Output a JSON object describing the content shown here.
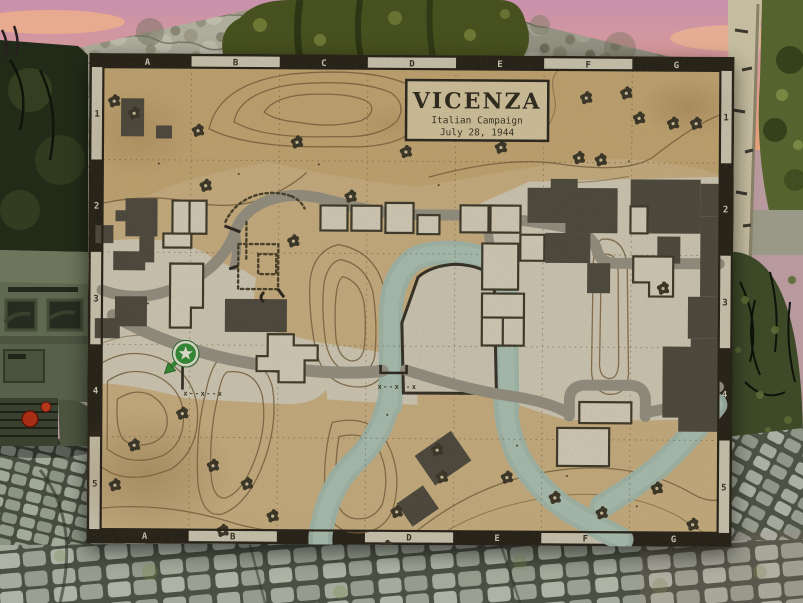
{
  "scene": {
    "colors": {
      "sky_pink": "#cf93ae",
      "sky_orange": "#e8a178",
      "tree_foliage": "#47501f",
      "stone_wall": "#a8a694",
      "cobblestone": "#99a191",
      "vehicle_olive": "#5f6850",
      "tail_light_red": "#a82f14"
    }
  },
  "map": {
    "title": "VICENZA",
    "campaign": "Italian Campaign",
    "date": "July 28, 1944",
    "grid": {
      "cols": [
        "A",
        "B",
        "C",
        "D",
        "E",
        "F",
        "G"
      ],
      "rows": [
        "1",
        "2",
        "3",
        "4",
        "5"
      ]
    },
    "fence_symbol": "x--x--x",
    "player_marker": {
      "symbol": "star",
      "facing": "southwest",
      "color": "#178a2c"
    },
    "colors": {
      "parchment": "#cdb386",
      "terrain_top": "#c5a673",
      "terrain_hill": "#d2ab69",
      "town_ground": "#d6d3c6",
      "river": "#aac9c2",
      "river_deep": "#9dbfba",
      "road": "#8f8f87",
      "building_dark": "#3a3a36",
      "building_light": "#dcd8ca",
      "frame": "#0b0b09",
      "band_light": "#d2cfc0",
      "contour": "#6d5737",
      "tree": "#23231b",
      "island_ground": "#d4d1c5"
    }
  }
}
